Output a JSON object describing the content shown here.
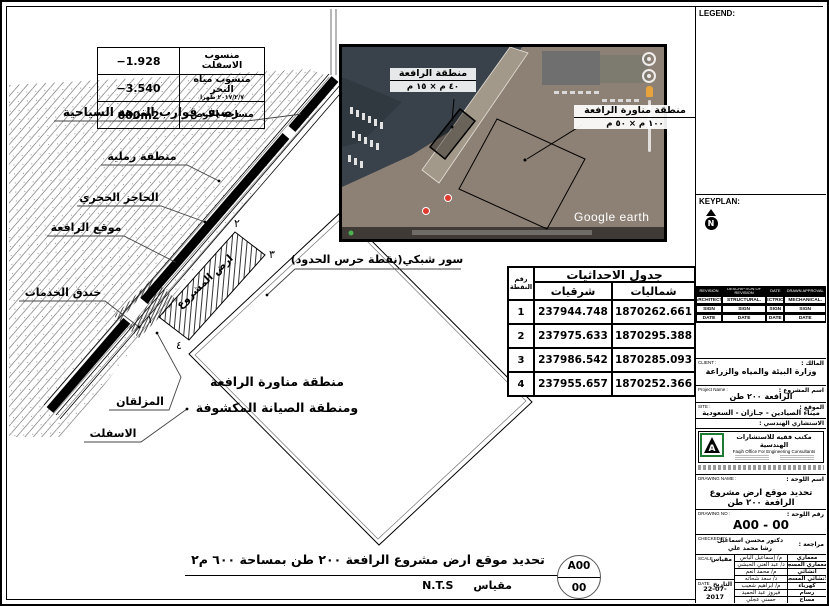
{
  "info_table": {
    "rows": [
      {
        "value": "−1.928",
        "label": "منسوب الاسفلت",
        "sub": ""
      },
      {
        "value": "−3.540",
        "label": "منسوب مياه البحر",
        "sub": "٢٠١٧/٢/٧ ظهرا"
      },
      {
        "value": "600m2",
        "label": "مساحة الارض",
        "sub": ""
      }
    ]
  },
  "plan_labels": {
    "quay": "رصيف قوارب النزهة السياحية",
    "sandy_area": "منطقة رملية",
    "stone_barrier": "الحاجز الحجري",
    "crane_location": "موقع الرافعة",
    "services_trench": "خندق الخدمات",
    "slipway": "المزلقان",
    "asphalt": "الاسفلت",
    "fence": "سور شبكي(نقطة حرس الحدود)",
    "project_land": "ارض المشروع",
    "maneuver_line1": "منطقة مناورة الرافعة",
    "maneuver_line2": "ومنطقة الصيانة المكشوفة",
    "corner_1": "١",
    "corner_2": "٢",
    "corner_3": "٣",
    "corner_4": "٤"
  },
  "satellite": {
    "crane_area_label": "منطقة الرافعة",
    "crane_area_dims": "٤٠ م × ١٥ م",
    "maneuver_area_label": "منطقة مناورة الرافعة",
    "maneuver_area_dims": "١٠٠ م × ٥٠ م",
    "watermark": "Google earth"
  },
  "coords_table": {
    "title": "جدول الاحداثيات",
    "col_point_1": "رقم",
    "col_point_2": "النقطة",
    "col_easting": "شرقيات",
    "col_northing": "شماليات",
    "rows": [
      {
        "no": "1",
        "e": "237944.748",
        "n": "1870262.661"
      },
      {
        "no": "2",
        "e": "237975.633",
        "n": "1870295.388"
      },
      {
        "no": "3",
        "e": "237986.542",
        "n": "1870285.093"
      },
      {
        "no": "4",
        "e": "237955.657",
        "n": "1870252.366"
      }
    ]
  },
  "bottom": {
    "title": "تحديد موقع ارض مشروع الرافعة ٢٠٠ طن بمساحة ٦٠٠ م٢",
    "scale_value": "N.T.S",
    "scale_label": "مقياس",
    "sheet_top": "A00",
    "sheet_bottom": "00"
  },
  "titleblock": {
    "legend_label": "LEGEND:",
    "keyplan_label": "KEYPLAN:",
    "north_letter": "N",
    "rev_headers": [
      "REVISION",
      "DESCRIPTION OF REVISION",
      "DATE",
      "DRAWN APPROVAL"
    ],
    "disciplines": [
      "ARCHITECT.",
      "STRUCTURAL.",
      "ELECTRICAL.",
      "MECHANICAL."
    ],
    "sign_label": "SIGN",
    "date_label": "DATE",
    "client_label_en": "CLIENT :",
    "client_label_ar": "المالك :",
    "client_value": "وزارة البيئة والمياه والزراعة",
    "project_label_en": "Project Name :",
    "project_label_ar": "اسم المشروع :",
    "project_value": "الرافعة ٢٠٠ طن",
    "site_label_en": "SITE :",
    "site_label_ar": "الموقع :",
    "site_value": "ميناء الصيادين - جـازان - السعودية",
    "consultant_label_ar": "الاستشاري الهندسي :",
    "consultant_name_ar": "مكتب فقيه للاستشارات الهندسية",
    "consultant_name_en": "Faqih Office For Engineering Consultants",
    "drawing_name_label_en": "DRAWING NAME :",
    "drawing_name_label_ar": "اسم اللوحة :",
    "drawing_name_value": "تحديد موقع ارض مشروع الرافعة ٢٠٠ طن",
    "drawing_no_label_en": "DRAWING NO :",
    "drawing_no_label_ar": "رقم اللوحة :",
    "drawing_no_value": "A00 - 00",
    "checked_label_en": "CHECKED BY",
    "checked_label_ar": "مراجعة :",
    "checked_value_1": "دكتور محسن اسماعيل",
    "checked_value_2": "رشا محمد علي",
    "scale_label_en": "SCALE",
    "scale_label_ar": "مقياس",
    "date_label_en": "DATE",
    "date_label_ar": "التاريخ",
    "date_value": "22-07-2017",
    "staff": [
      {
        "role": "معماري",
        "name": "م/ إسماعيل الياس"
      },
      {
        "role": "المعماري المسجل",
        "name": "د/ عبد الغني الحبشي"
      },
      {
        "role": "انشائي",
        "name": "م/ محمد أنعم"
      },
      {
        "role": "الانشائي المسجل",
        "name": "د/ سعد شحاته"
      },
      {
        "role": "كهرباء",
        "name": "م/ ابراهيم شعيب"
      },
      {
        "role": "رسام",
        "name": "فيروز عبد الحميد"
      },
      {
        "role": "مساح",
        "name": "حسني عجلي"
      }
    ]
  }
}
